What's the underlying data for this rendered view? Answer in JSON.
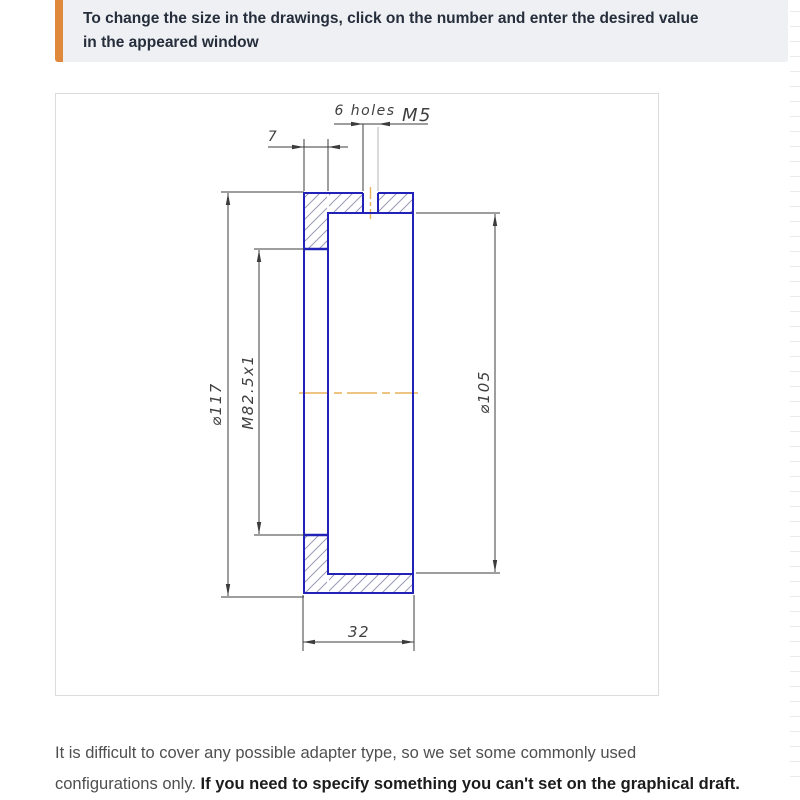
{
  "callout": {
    "lines": [
      "To change the size in the drawings, click on the number and enter the desired value",
      "in the appeared window"
    ],
    "accent_color": "#e0883c",
    "background_color": "#eef0f4"
  },
  "drawing": {
    "type": "technical-section-view",
    "part": "adapter ring cross-section",
    "outline_color": "#2222b8",
    "centerline_color": "#e9b158",
    "hatch_color": "#9a9ab6",
    "dimension_color": "#3c3c3c",
    "dimensions": {
      "holes_count": "6 holes",
      "holes_thread": "M5",
      "flange_thickness": "7",
      "outer_diameter": "⌀117",
      "thread_spec": "M82.5x1",
      "bore_diameter": "⌀105",
      "total_width": "32"
    }
  },
  "paragraph": {
    "line1": "It is difficult to cover any possible adapter type, so we set some commonly used",
    "line2_regular": "configurations only. ",
    "line2_bold": "If you need to specify something you can't set on the graphical draft."
  }
}
